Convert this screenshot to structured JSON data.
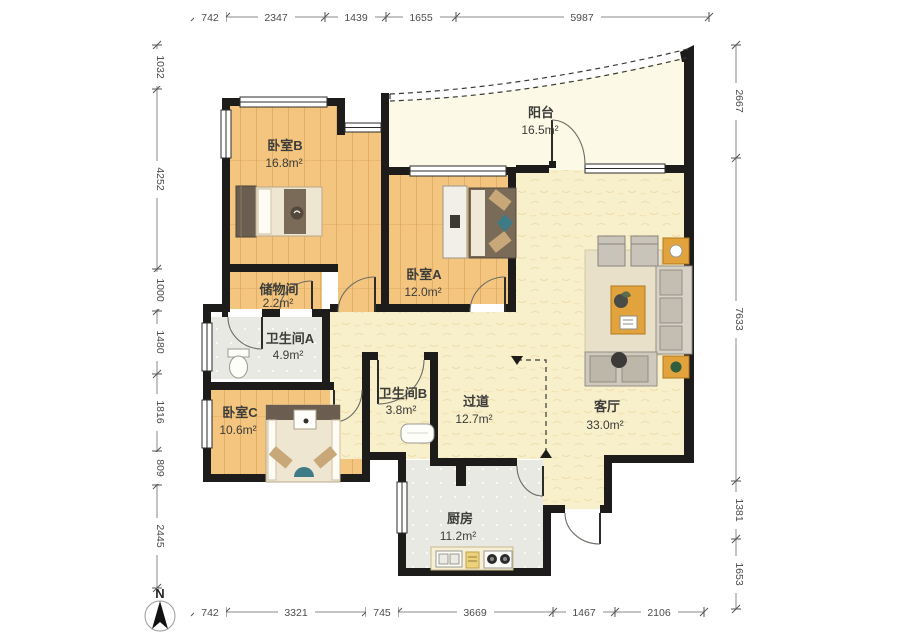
{
  "title": "apartment-floor-plan",
  "north_label": "N",
  "rooms": [
    {
      "id": "bedroom-b",
      "name": "卧室B",
      "area": "16.8m²"
    },
    {
      "id": "balcony",
      "name": "阳台",
      "area": "16.5m²"
    },
    {
      "id": "storage",
      "name": "储物间",
      "area": "2.2m²"
    },
    {
      "id": "bedroom-a",
      "name": "卧室A",
      "area": "12.0m²"
    },
    {
      "id": "bathroom-a",
      "name": "卫生间A",
      "area": "4.9m²"
    },
    {
      "id": "bathroom-b",
      "name": "卫生间B",
      "area": "3.8m²"
    },
    {
      "id": "hallway",
      "name": "过道",
      "area": "12.7m²"
    },
    {
      "id": "living-room",
      "name": "客厅",
      "area": "33.0m²"
    },
    {
      "id": "bedroom-c",
      "name": "卧室C",
      "area": "10.6m²"
    },
    {
      "id": "kitchen",
      "name": "厨房",
      "area": "11.2m²"
    }
  ],
  "dimensions": {
    "top": [
      "742",
      "2347",
      "1439",
      "1655",
      "5987"
    ],
    "bottom": [
      "742",
      "3321",
      "745",
      "3669",
      "1467",
      "2106"
    ],
    "left": [
      "1032",
      "4252",
      "1000",
      "1480",
      "1816",
      "809",
      "2445"
    ],
    "right": [
      "2667",
      "7633",
      "1381",
      "1653"
    ]
  },
  "colors": {
    "wall": "#1d1c1a",
    "wood": "#f3c57e",
    "wood_line": "#dfa95f",
    "tile": "#e9e9e4",
    "pale": "#f8efcb",
    "balcony": "#fcfae6",
    "accent_orange": "#e2a23c",
    "accent_teal": "#3d7b86",
    "sofa_grey": "#cfc9bd",
    "bed_dark": "#6b5d4f"
  }
}
